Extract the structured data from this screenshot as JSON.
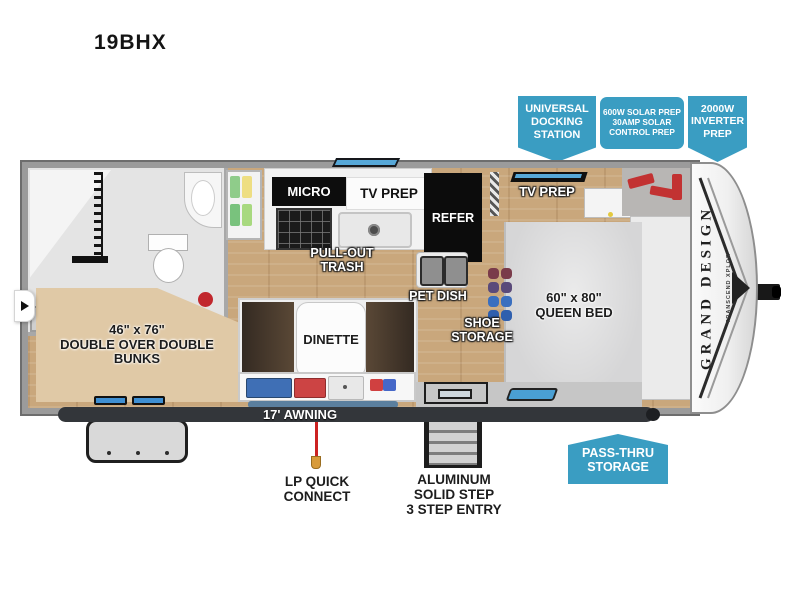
{
  "page": {
    "title": "19BHX"
  },
  "badges": {
    "universal_docking": "UNIVERSAL\nDOCKING\nSTATION",
    "solar_prep": "600W SOLAR PREP\n30AMP SOLAR\nCONTROL PREP",
    "inverter_prep": "2000W\nINVERTER\nPREP",
    "pass_thru": "PASS-THRU\nSTORAGE"
  },
  "labels": {
    "linen": "LINEN",
    "micro": "MICRO",
    "tv_prep_kitchen": "TV PREP",
    "pull_out_trash": "PULL-OUT\nTRASH",
    "refer": "REFER",
    "pet_dish": "PET DISH",
    "tv_prep_bedroom": "TV PREP",
    "queen_bed": "60\" x 80\"\nQUEEN BED",
    "dinette": "DINETTE",
    "shoe_storage": "SHOE\nSTORAGE",
    "bunks": "46\" x 76\"\nDOUBLE OVER DOUBLE\nBUNKS",
    "awning": "17' AWNING",
    "lp_quick_connect": "LP QUICK\nCONNECT",
    "step_entry": "ALUMINUM\nSOLID STEP\n3 STEP ENTRY"
  },
  "brand": {
    "name": "GRAND DESIGN",
    "series": "TRANSCEND XPLOR"
  },
  "colors": {
    "badge_blue": "#3a9dc2",
    "window_blue": "#57a8d8",
    "awning_dark": "#33363a",
    "lp_red": "#cc2222",
    "floor_wood": "#c9a77c",
    "bunk_tan": "#e0c9a6"
  }
}
